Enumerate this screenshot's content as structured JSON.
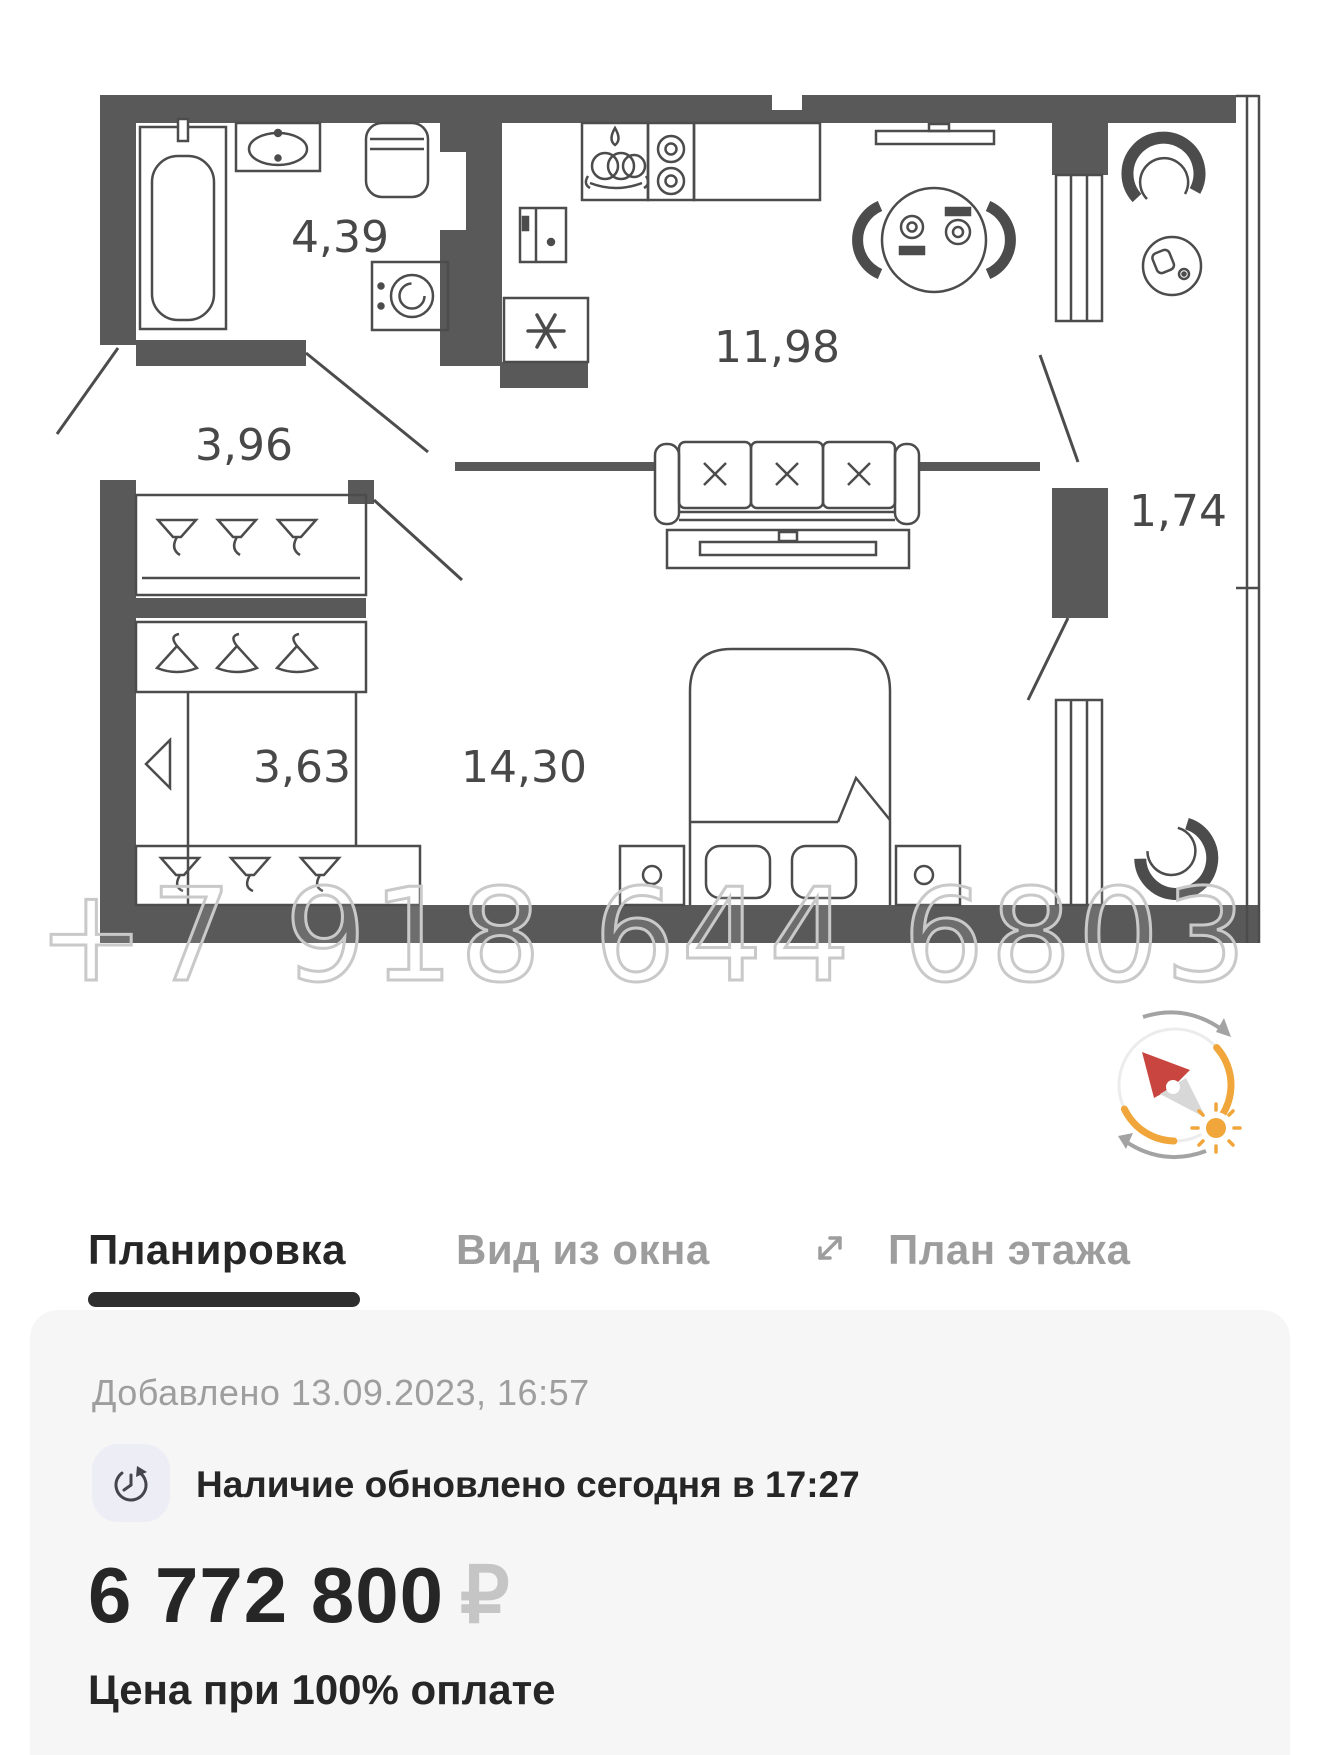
{
  "floor_plan": {
    "watermark": "+7 918 644 6803",
    "rooms": [
      {
        "name": "bathroom",
        "area": "4,39"
      },
      {
        "name": "hallway",
        "area": "3,96"
      },
      {
        "name": "kitchen-living-room",
        "area": "11,98"
      },
      {
        "name": "balcony",
        "area": "1,74"
      },
      {
        "name": "wardrobe",
        "area": "3,63"
      },
      {
        "name": "bedroom",
        "area": "14,30"
      }
    ]
  },
  "tabs": {
    "plan": {
      "label": "Планировка",
      "active": true
    },
    "window_view": {
      "label": "Вид из окна",
      "active": false
    },
    "floor_plan": {
      "label": "План этажа",
      "active": false
    }
  },
  "panel": {
    "added": "Добавлено 13.09.2023, 16:57",
    "availability": "Наличие обновлено сегодня в 17:27",
    "price": "6 772 800",
    "currency": "₽",
    "price_note": "Цена при 100% оплате"
  },
  "colors": {
    "wall_gray": "#595959",
    "plan_line": "#4c4c4c",
    "accent_orange": "#f0a63a",
    "needle_red": "#c9453f",
    "active_tab": "#262626",
    "inactive_tab": "#9d9d9d",
    "panel_bg": "#f6f6f7"
  }
}
